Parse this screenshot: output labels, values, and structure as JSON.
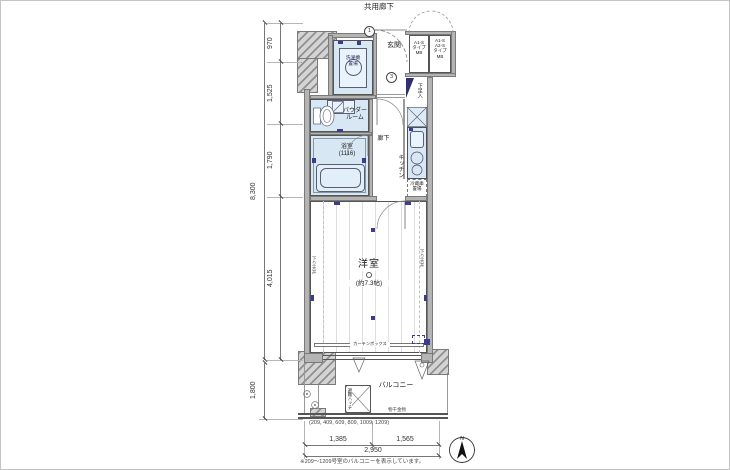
{
  "plan": {
    "corridor": "共用廊下",
    "entrance": "玄関",
    "washer": "洗濯機\n置場",
    "mb_left": "A1-S\nタイプ\nMB",
    "mb_right": "A1-S\nA2-S\nタイプ\nMB",
    "shoe_box": "下足入",
    "powder_room": "パウダー\nルーム",
    "bathroom": "浴室\n(1116)",
    "hallway": "廊下",
    "kitchen": "キッチン",
    "fridge": "冷蔵庫\n置場",
    "main_room": "洋室",
    "main_room_size": "(約7.3帖)",
    "curtain_box": "カーテンボックス",
    "lowered_ceiling_left": "下り天井",
    "lowered_ceiling_right": "下り天井",
    "balcony": "バルコニー",
    "escape_hatch": "避難ハッチ",
    "laundry_hardware": "物干金物",
    "marker_1": "1",
    "marker_3": "3"
  },
  "dimensions": {
    "left_total": "8,300",
    "left_segments": [
      "970",
      "1,525",
      "1,790",
      "4,015"
    ],
    "balcony_depth": "1,800",
    "bottom_segments": [
      "1,385",
      "1,565"
    ],
    "bottom_total": "2,950"
  },
  "footer": {
    "room_numbers": "(209, 409, 609, 809, 1009, 1209)",
    "note": "※209〜1209号室のバルコニーを表示しています。"
  },
  "compass": {
    "north": "N"
  },
  "colors": {
    "wet_floor": "#d7e7f4",
    "wall": "#b4b4b4",
    "fixture_accent": "#3c3c8e"
  }
}
